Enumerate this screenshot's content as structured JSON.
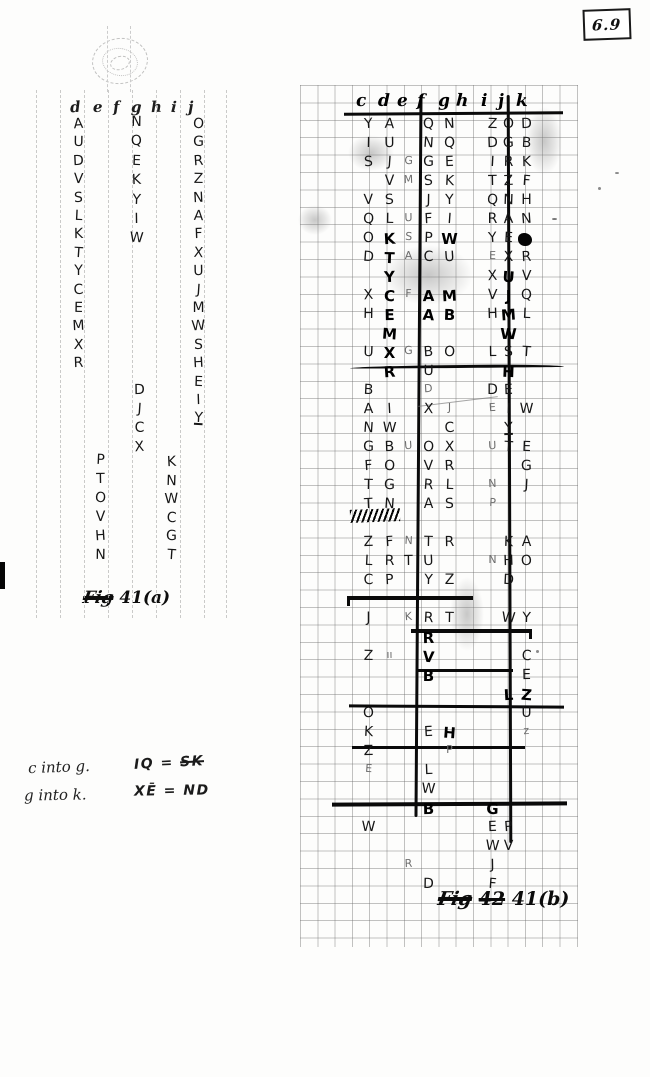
{
  "page_number": "6.9",
  "fig_a": {
    "caption_prefix": "Fig",
    "caption_label": "41(a)",
    "header": [
      [
        "d",
        40
      ],
      [
        "e",
        63
      ],
      [
        "f",
        83
      ],
      [
        "g",
        101
      ],
      [
        "h",
        121
      ],
      [
        "i",
        141
      ],
      [
        "j",
        158
      ]
    ],
    "columns": [
      {
        "x": 40,
        "y": 26,
        "step": 18.4,
        "letters": "A U D V S L K T Y C E M X R"
      },
      {
        "x": 62,
        "y": 362,
        "step": 19,
        "letters": "P T O V H N"
      },
      {
        "x": 98,
        "y": 24,
        "step": 19.4,
        "letters": "N Q E K Y I W"
      },
      {
        "x": 101,
        "y": 292,
        "step": 19,
        "letters": "D J C X"
      },
      {
        "x": 133,
        "y": 364,
        "step": 18.6,
        "letters": "K N W C G T"
      },
      {
        "x": 160,
        "y": 26,
        "step": 18.4,
        "letters": "O G R Z N A F X U J M W S H E I Y",
        "underline_last": true
      }
    ]
  },
  "fig_b": {
    "caption_prefix": "Fig",
    "caption_struck": "42",
    "caption_label": "41(b)",
    "header": [
      [
        "c",
        56
      ],
      [
        "d",
        78
      ],
      [
        "e",
        97
      ],
      [
        "f",
        117
      ],
      [
        "g",
        138
      ],
      [
        "h",
        156
      ],
      [
        "i",
        181
      ],
      [
        "j",
        198
      ],
      [
        "k",
        216
      ]
    ],
    "col_x": [
      60,
      81,
      100,
      120,
      141,
      161,
      184,
      200,
      218
    ],
    "row_y0": 31,
    "row_h": 19,
    "letters": [
      [
        0,
        0,
        "Y"
      ],
      [
        1,
        0,
        "A"
      ],
      [
        3,
        0,
        "Q"
      ],
      [
        4,
        0,
        "N"
      ],
      [
        6,
        0,
        "Z"
      ],
      [
        7,
        0,
        "O"
      ],
      [
        8,
        0,
        "D"
      ],
      [
        0,
        1,
        "I"
      ],
      [
        1,
        1,
        "U"
      ],
      [
        3,
        1,
        "N"
      ],
      [
        4,
        1,
        "Q"
      ],
      [
        6,
        1,
        "D"
      ],
      [
        7,
        1,
        "G"
      ],
      [
        8,
        1,
        "B"
      ],
      [
        0,
        2,
        "S"
      ],
      [
        1,
        2,
        "J"
      ],
      [
        2,
        2,
        "G",
        "s"
      ],
      [
        3,
        2,
        "G"
      ],
      [
        4,
        2,
        "E"
      ],
      [
        6,
        2,
        "I"
      ],
      [
        7,
        2,
        "R"
      ],
      [
        8,
        2,
        "K"
      ],
      [
        1,
        3,
        "V"
      ],
      [
        2,
        3,
        "M",
        "s"
      ],
      [
        3,
        3,
        "S"
      ],
      [
        4,
        3,
        "K"
      ],
      [
        6,
        3,
        "T"
      ],
      [
        7,
        3,
        "Z"
      ],
      [
        8,
        3,
        "F"
      ],
      [
        0,
        4,
        "V"
      ],
      [
        1,
        4,
        "S"
      ],
      [
        3,
        4,
        "J"
      ],
      [
        4,
        4,
        "Y"
      ],
      [
        6,
        4,
        "Q"
      ],
      [
        7,
        4,
        "N"
      ],
      [
        8,
        4,
        "H"
      ],
      [
        0,
        5,
        "Q"
      ],
      [
        1,
        5,
        "L"
      ],
      [
        2,
        5,
        "U",
        "s"
      ],
      [
        3,
        5,
        "F"
      ],
      [
        4,
        5,
        "I"
      ],
      [
        6,
        5,
        "R"
      ],
      [
        7,
        5,
        "A"
      ],
      [
        8,
        5,
        "N"
      ],
      [
        0,
        6,
        "O"
      ],
      [
        1,
        6,
        "K",
        "b"
      ],
      [
        2,
        6,
        "S",
        "s"
      ],
      [
        3,
        6,
        "P"
      ],
      [
        4,
        6,
        "W",
        "b"
      ],
      [
        6,
        6,
        "Y"
      ],
      [
        7,
        6,
        "E"
      ],
      [
        8,
        6,
        "",
        "blob"
      ],
      [
        0,
        7,
        "D"
      ],
      [
        1,
        7,
        "T",
        "b"
      ],
      [
        2,
        7,
        "A",
        "s"
      ],
      [
        3,
        7,
        "C"
      ],
      [
        4,
        7,
        "U"
      ],
      [
        6,
        7,
        "E",
        "s"
      ],
      [
        7,
        7,
        "X"
      ],
      [
        8,
        7,
        "R"
      ],
      [
        1,
        8,
        "Y",
        "b"
      ],
      [
        6,
        8,
        "X"
      ],
      [
        7,
        8,
        "U",
        "b"
      ],
      [
        8,
        8,
        "V"
      ],
      [
        0,
        9,
        "X"
      ],
      [
        1,
        9,
        "C",
        "b"
      ],
      [
        2,
        9,
        "F",
        "s"
      ],
      [
        3,
        9,
        "A",
        "b"
      ],
      [
        4,
        9,
        "M",
        "b"
      ],
      [
        6,
        9,
        "V"
      ],
      [
        7,
        9,
        "J",
        "b"
      ],
      [
        8,
        9,
        "Q"
      ],
      [
        0,
        10,
        "H"
      ],
      [
        1,
        10,
        "E",
        "b"
      ],
      [
        3,
        10,
        "A",
        "b"
      ],
      [
        4,
        10,
        "B",
        "b"
      ],
      [
        6,
        10,
        "H"
      ],
      [
        7,
        10,
        "M",
        "b"
      ],
      [
        8,
        10,
        "L"
      ],
      [
        1,
        11,
        "M",
        "b"
      ],
      [
        7,
        11,
        "W",
        "b"
      ],
      [
        0,
        12,
        "U"
      ],
      [
        1,
        12,
        "X",
        "b"
      ],
      [
        2,
        12,
        "G",
        "s"
      ],
      [
        3,
        12,
        "B"
      ],
      [
        4,
        12,
        "O"
      ],
      [
        6,
        12,
        "L"
      ],
      [
        7,
        12,
        "S"
      ],
      [
        8,
        12,
        "T"
      ],
      [
        1,
        13,
        "R",
        "b"
      ],
      [
        3,
        13,
        "U"
      ],
      [
        7,
        13,
        "H",
        "b"
      ],
      [
        0,
        14,
        "B"
      ],
      [
        3,
        14,
        "D",
        "s"
      ],
      [
        6,
        14,
        "D"
      ],
      [
        7,
        14,
        "E"
      ],
      [
        0,
        15,
        "A"
      ],
      [
        1,
        15,
        "I"
      ],
      [
        3,
        15,
        "X"
      ],
      [
        4,
        15,
        "J",
        "s"
      ],
      [
        6,
        15,
        "E",
        "s"
      ],
      [
        7,
        15,
        "I"
      ],
      [
        8,
        15,
        "W"
      ],
      [
        0,
        16,
        "N"
      ],
      [
        1,
        16,
        "W"
      ],
      [
        4,
        16,
        "C"
      ],
      [
        7,
        16,
        "Y",
        "u"
      ],
      [
        0,
        17,
        "G"
      ],
      [
        1,
        17,
        "B"
      ],
      [
        2,
        17,
        "U",
        "s"
      ],
      [
        3,
        17,
        "O"
      ],
      [
        4,
        17,
        "X"
      ],
      [
        6,
        17,
        "U",
        "s"
      ],
      [
        7,
        17,
        "T"
      ],
      [
        8,
        17,
        "E"
      ],
      [
        0,
        18,
        "F"
      ],
      [
        1,
        18,
        "O"
      ],
      [
        3,
        18,
        "V"
      ],
      [
        4,
        18,
        "R"
      ],
      [
        8,
        18,
        "G"
      ],
      [
        0,
        19,
        "T"
      ],
      [
        1,
        19,
        "G"
      ],
      [
        3,
        19,
        "R"
      ],
      [
        4,
        19,
        "L"
      ],
      [
        6,
        19,
        "N",
        "s"
      ],
      [
        8,
        19,
        "J"
      ],
      [
        0,
        20,
        "T"
      ],
      [
        1,
        20,
        "N"
      ],
      [
        3,
        20,
        "A"
      ],
      [
        4,
        20,
        "S"
      ],
      [
        6,
        20,
        "P",
        "s"
      ],
      [
        0,
        22,
        "Z"
      ],
      [
        1,
        22,
        "F"
      ],
      [
        2,
        22,
        "N",
        "s"
      ],
      [
        3,
        22,
        "T"
      ],
      [
        4,
        22,
        "R"
      ],
      [
        7,
        22,
        "K"
      ],
      [
        8,
        22,
        "A"
      ],
      [
        0,
        23,
        "L"
      ],
      [
        1,
        23,
        "R"
      ],
      [
        2,
        23,
        "T"
      ],
      [
        3,
        23,
        "U"
      ],
      [
        6,
        23,
        "N",
        "s"
      ],
      [
        7,
        23,
        "H"
      ],
      [
        8,
        23,
        "O"
      ],
      [
        0,
        24,
        "C"
      ],
      [
        1,
        24,
        "P"
      ],
      [
        3,
        24,
        "Y"
      ],
      [
        4,
        24,
        "Z"
      ],
      [
        7,
        24,
        "D"
      ],
      [
        0,
        26,
        "J"
      ],
      [
        2,
        26,
        "K",
        "s"
      ],
      [
        3,
        26,
        "R"
      ],
      [
        4,
        26,
        "T"
      ],
      [
        7,
        26,
        "W"
      ],
      [
        8,
        26,
        "Y"
      ],
      [
        3,
        27,
        "R",
        "b"
      ],
      [
        0,
        28,
        "Z"
      ],
      [
        1,
        28,
        "ıı",
        "s"
      ],
      [
        3,
        28,
        "V",
        "b"
      ],
      [
        8,
        28,
        "C"
      ],
      [
        3,
        29,
        "B",
        "b"
      ],
      [
        8,
        29,
        "E"
      ],
      [
        7,
        30,
        "L",
        "b"
      ],
      [
        8,
        30,
        "Z",
        "b"
      ],
      [
        0,
        31,
        "O"
      ],
      [
        8,
        31,
        "U"
      ],
      [
        0,
        32,
        "K"
      ],
      [
        3,
        32,
        "E"
      ],
      [
        4,
        32,
        "H",
        "b"
      ],
      [
        8,
        32,
        "z",
        "s"
      ],
      [
        0,
        33,
        "Z"
      ],
      [
        4,
        33,
        "P",
        "s"
      ],
      [
        0,
        34,
        "E",
        "s"
      ],
      [
        3,
        34,
        "L"
      ],
      [
        3,
        35,
        "W"
      ],
      [
        3,
        36,
        "B",
        "b"
      ],
      [
        6,
        36,
        "G",
        "b"
      ],
      [
        0,
        37,
        "W"
      ],
      [
        6,
        37,
        "E"
      ],
      [
        7,
        37,
        "P"
      ],
      [
        6,
        38,
        "W"
      ],
      [
        7,
        38,
        "V"
      ],
      [
        2,
        39,
        "R",
        "s"
      ],
      [
        6,
        39,
        "J"
      ],
      [
        3,
        40,
        "D"
      ],
      [
        6,
        40,
        "F"
      ]
    ]
  },
  "notes": {
    "line1_left": "c into g.",
    "line2_left": "g into k.",
    "line1_pre": "IQ = ",
    "line1_struck": "SK",
    "line2_text": "XĒ = ND"
  }
}
